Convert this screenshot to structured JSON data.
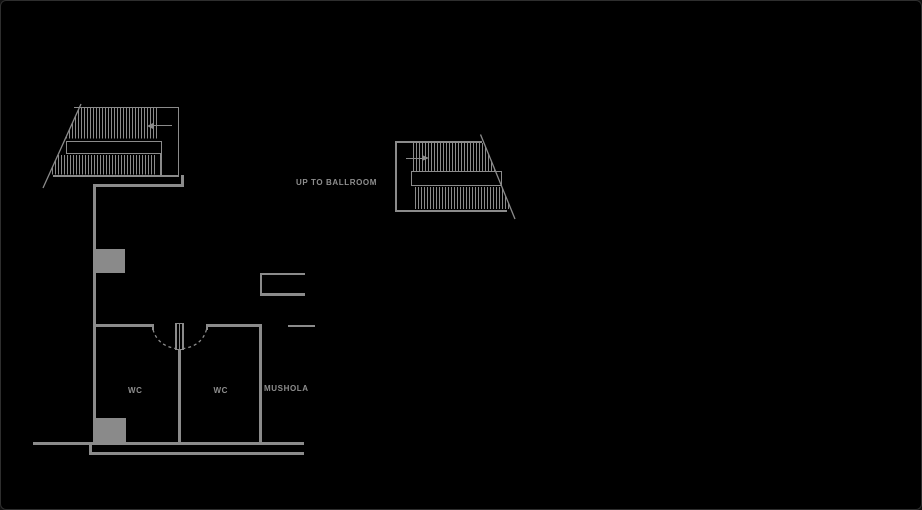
{
  "drawing": {
    "type": "floor-plan",
    "labels": {
      "stair_annotation": "UP TO BALLROOM",
      "room_wc_left": "WC",
      "room_wc_right": "WC",
      "room_mushola": "MUSHOLA"
    },
    "icons": {
      "stair1_direction": "arrow-left",
      "stair2_direction": "arrow-right"
    },
    "colors": {
      "background": "#000000",
      "line": "#8b8b8b",
      "fill": "#8a8a8a",
      "text": "#8e8e8e",
      "frame": "#2e2e2e"
    }
  }
}
